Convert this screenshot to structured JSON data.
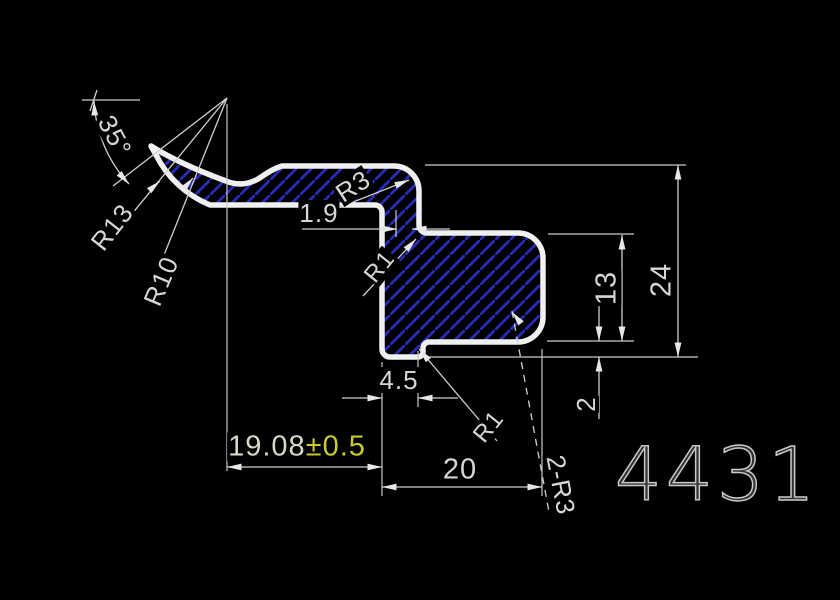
{
  "drawing": {
    "type": "cad-profile-cross-section",
    "part_number": "4431"
  },
  "labels": {
    "angle_35": "35°",
    "r13": "R13",
    "r10": "R10",
    "r3": "R3",
    "dim_1_9": "1.9",
    "r1_upper": "R1",
    "dim_13": "13",
    "dim_24": "24",
    "dim_4_5": "4.5",
    "dim_2": "2",
    "dim_19_08": "19.08",
    "dim_19_08_tol": "±0.5",
    "dim_20": "20",
    "r1_lower": "R1",
    "two_r3": "2-R3",
    "part_number": "4431"
  },
  "colors": {
    "background": "#000000",
    "profile_outline": "#f0f0f0",
    "hatch": "#2a2ab8",
    "dimension_lines": "#c9c9c9",
    "dimension_text": "#d6d6d6",
    "tolerance_text": "#c9c92b",
    "part_number_text": "#c9c9c9"
  }
}
